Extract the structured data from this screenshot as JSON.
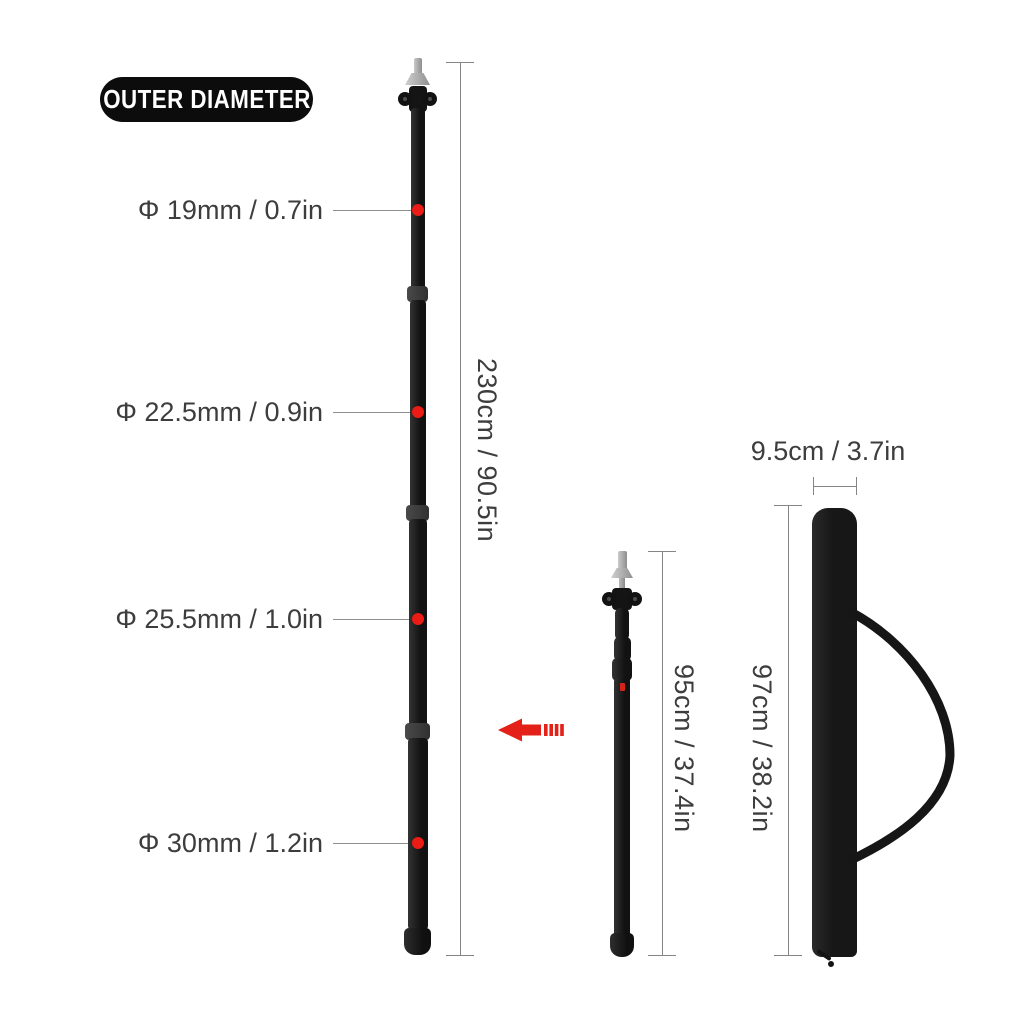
{
  "badge": {
    "label": "OUTER DIAMETER"
  },
  "diameter_labels": [
    {
      "label": "Φ 19mm / 0.7in"
    },
    {
      "label": "Φ 22.5mm / 0.9in"
    },
    {
      "label": "Φ 25.5mm / 1.0in"
    },
    {
      "label": "Φ 30mm / 1.2in"
    }
  ],
  "measurements": {
    "extended_pole_length": "230cm / 90.5in",
    "collapsed_pole_length": "95cm / 37.4in",
    "bag_length": "97cm / 38.2in",
    "bag_width": "9.5cm / 3.7in"
  },
  "colors": {
    "accent_red": "#ea1c15",
    "pole_black": "#171717",
    "line_gray": "#858585",
    "text_dark": "#3d3d3d",
    "badge_bg": "#0c0c0c",
    "badge_text": "#ffffff"
  }
}
